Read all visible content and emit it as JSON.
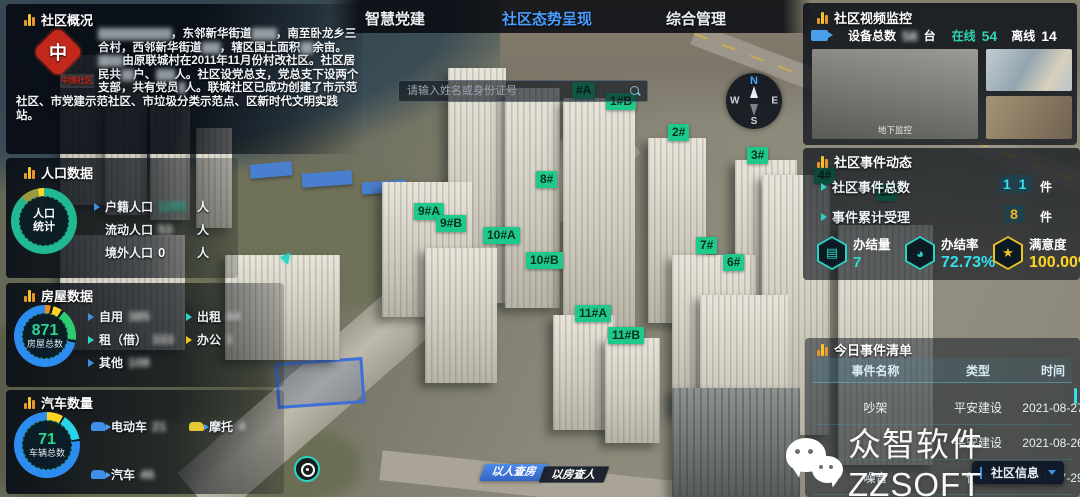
{
  "tabs": {
    "items": [
      {
        "label": "智慧党建"
      },
      {
        "label": "社区态势呈现"
      },
      {
        "label": "综合管理"
      }
    ]
  },
  "search": {
    "placeholder": "请输入姓名或身份证号"
  },
  "compass": {
    "n": "N",
    "e": "E",
    "s": "S",
    "w": "W"
  },
  "overview": {
    "title": "社区概况",
    "logo_text": "中国社区",
    "segments": [
      "████████████",
      "，东邻新华街道",
      "████",
      "，南至卧龙乡三合村，西邻新华街道",
      "███",
      "，辖区国土面积",
      "██",
      "余亩。",
      "████",
      "由原联城村在2011年11月份村改社区。社区居民共",
      "██",
      "户、",
      "███",
      "人。社区设党总支，党总支下设两个支部，共有党员",
      "█",
      "人。联城社区已成功创建了市示范社区、市党建示范社区、市垃圾分类示范点、区新时代文明实践站。"
    ]
  },
  "population": {
    "title": "人口数据",
    "chart_label_line1": "人口",
    "chart_label_line2": "统计",
    "rows": [
      {
        "label": "户籍人口",
        "value": "1285",
        "unit": "人"
      },
      {
        "label": "流动人口",
        "value": "53",
        "unit": "人"
      },
      {
        "label": "境外人口",
        "value": "0",
        "unit": "人"
      }
    ]
  },
  "housing": {
    "title": "房屋数据",
    "total": "871",
    "total_label": "房屋总数",
    "col1": [
      {
        "label": "自用",
        "value": "385"
      },
      {
        "label": "租（借）",
        "value": "333"
      },
      {
        "label": "其他",
        "value": "108"
      }
    ],
    "col2": [
      {
        "label": "出租",
        "value": "44"
      },
      {
        "label": "办公",
        "value": "1"
      }
    ]
  },
  "vehicles": {
    "title": "汽车数量",
    "total": "71",
    "total_label": "车辆总数",
    "rows": [
      {
        "label": "电动车",
        "value": "21"
      },
      {
        "label": "摩托",
        "value": "4"
      },
      {
        "label": "汽车",
        "value": "46"
      }
    ]
  },
  "video": {
    "title": "社区视频监控",
    "device_label": "设备总数",
    "device_value": "58",
    "device_unit": "台",
    "online_label": "在线",
    "online_value": "54",
    "offline_label": "离线",
    "offline_value": "14",
    "caption": "地下监控"
  },
  "events": {
    "title": "社区事件动态",
    "total_label": "社区事件总数",
    "total_value": "1 1",
    "total_unit": "件",
    "accepted_label": "事件累计受理",
    "accepted_value": "8",
    "accepted_unit": "件",
    "stats": [
      {
        "label": "办结量",
        "value": "7"
      },
      {
        "label": "办结率",
        "value": "72.73%"
      },
      {
        "label": "满意度",
        "value": "100.00%"
      }
    ]
  },
  "event_list": {
    "title": "今日事件清单",
    "columns": [
      "事件名称",
      "类型",
      "时间"
    ],
    "rows": [
      {
        "name": "吵架",
        "type": "平安建设",
        "time": "2021-08-27"
      },
      {
        "name": "",
        "type": "平安建设",
        "time": "2021-08-26"
      },
      {
        "name": "噪音",
        "type": "信访",
        "time": "2021-07-29"
      }
    ]
  },
  "map": {
    "building_labels": [
      "#A",
      "1#B",
      "2#",
      "3#",
      "8#",
      "9#A",
      "9#B",
      "10#A",
      "10#B",
      "7#",
      "6#",
      "11#A",
      "11#B",
      "4#",
      "5#"
    ]
  },
  "footer": {
    "person_to_house": "以人查房",
    "house_to_person": "以房查人",
    "community_info": "社区信息"
  },
  "watermark": {
    "text": "众智软件ZZSOFT"
  },
  "colors": {
    "accent_teal": "#1fd1a5",
    "accent_cyan": "#35e0ee",
    "accent_yellow": "#ffd524",
    "accent_blue": "#4a9eff",
    "badge_green": "#1fc98c"
  }
}
